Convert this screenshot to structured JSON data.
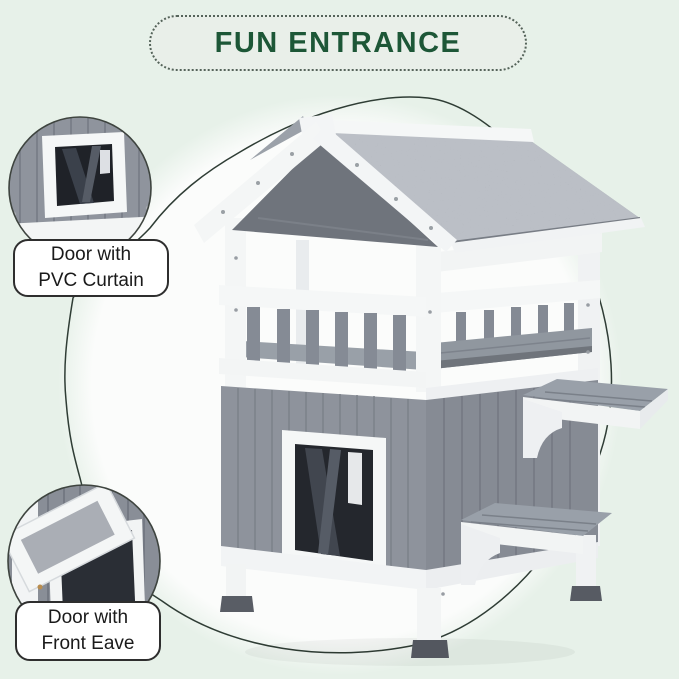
{
  "header": {
    "title": "FUN ENTRANCE"
  },
  "callouts": [
    {
      "id": "pvc-curtain",
      "line1": "Door with",
      "line2": "PVC Curtain"
    },
    {
      "id": "front-eave",
      "line1": "Door with",
      "line2": "Front Eave"
    }
  ],
  "illustration": {
    "subject": "two-story wooden cat house with gray asphalt roof, balcony railing, PVC-curtain door and side step platforms"
  },
  "colors": {
    "page_background": "#e7f1e9",
    "title_green": "#1d5737",
    "pill_background": "#e9efe9",
    "swoosh_line": "#2f3d35",
    "label_border": "#2e2e2e",
    "label_text": "#1a1a1a",
    "white_wood": "#f5f7f7",
    "panel_gray": "#8e939c",
    "roof_asphalt_gray": "#9ba1a9",
    "foot_dark_gray": "#575b63",
    "photo_background_white": "#fbfcfb"
  }
}
